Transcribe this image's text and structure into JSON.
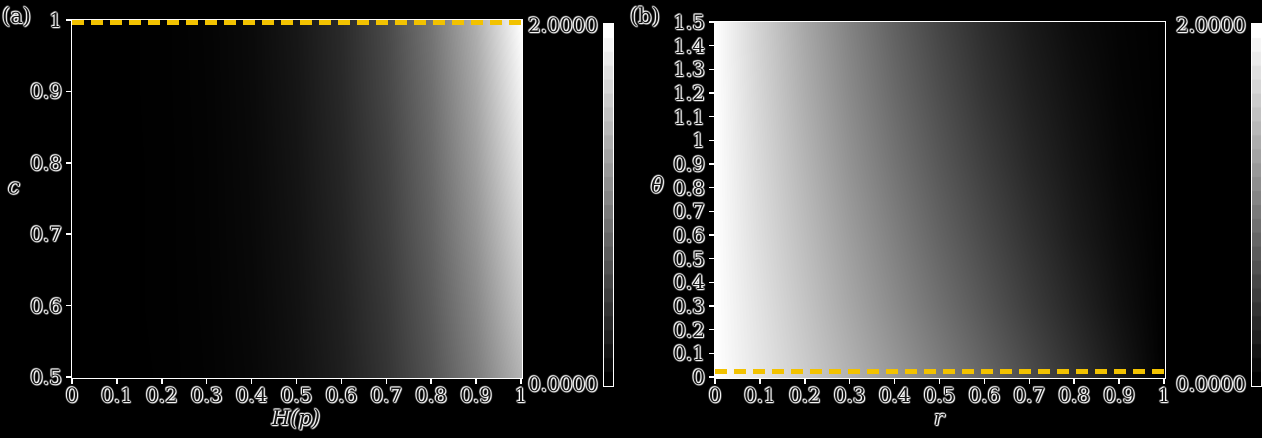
{
  "figure": {
    "background": "#000000",
    "text_color": "#161616",
    "halo_color": "#ffffff",
    "axis_color": "#ffffff",
    "dash_color": "#f2c200"
  },
  "panel_a": {
    "tag": "(a)",
    "xlabel": "H(p)",
    "ylabel": "c",
    "x_tick_labels": [
      "0",
      "0.1",
      "0.2",
      "0.3",
      "0.4",
      "0.5",
      "0.6",
      "0.7",
      "0.8",
      "0.9",
      "1"
    ],
    "y_tick_labels": [
      "1",
      "0.9",
      "0.8",
      "0.7",
      "0.6",
      "0.5"
    ],
    "colorbar": {
      "max_label": "2.0000",
      "min_label": "0.0000"
    },
    "dashed_line": "horizontal dashed line at c = 1 (top edge)"
  },
  "panel_b": {
    "tag": "(b)",
    "xlabel": "r",
    "ylabel": "θ",
    "x_tick_labels": [
      "0",
      "0.1",
      "0.2",
      "0.3",
      "0.4",
      "0.5",
      "0.6",
      "0.7",
      "0.8",
      "0.9",
      "1"
    ],
    "y_tick_labels": [
      "1.5",
      "1.4",
      "1.3",
      "1.2",
      "1.1",
      "1",
      "0.9",
      "0.8",
      "0.7",
      "0.6",
      "0.5",
      "0.4",
      "0.3",
      "0.2",
      "0.1",
      "0"
    ],
    "colorbar": {
      "max_label": "2.0000",
      "min_label": "0.0000"
    },
    "dashed_line": "horizontal dashed line at θ = 0 (bottom edge)"
  },
  "chart_data": [
    {
      "type": "heatmap",
      "panel": "a",
      "xlabel": "H(p)",
      "ylabel": "c",
      "x": [
        0,
        0.1,
        0.2,
        0.3,
        0.4,
        0.5,
        0.6,
        0.7,
        0.8,
        0.9,
        1
      ],
      "y": [
        1.0,
        0.9,
        0.8,
        0.7,
        0.6,
        0.5
      ],
      "xlim": [
        0,
        1
      ],
      "ylim": [
        0.5,
        1
      ],
      "zlim": [
        0,
        2
      ],
      "colormap": "grayscale (0 = black, 2 = white)",
      "colorbar_ticks": [
        "2.0000",
        "0.0000"
      ],
      "annotation": "yellow dashed line at c = 1",
      "values": [
        [
          0,
          0.001,
          0.007,
          0.03,
          0.08,
          0.18,
          0.33,
          0.57,
          0.92,
          1.38,
          2.0
        ],
        [
          0,
          0.001,
          0.007,
          0.028,
          0.077,
          0.17,
          0.32,
          0.55,
          0.87,
          1.31,
          1.9
        ],
        [
          0,
          0.001,
          0.006,
          0.026,
          0.072,
          0.16,
          0.3,
          0.51,
          0.82,
          1.24,
          1.79
        ],
        [
          0,
          0.001,
          0.006,
          0.025,
          0.068,
          0.15,
          0.28,
          0.48,
          0.77,
          1.16,
          1.67
        ],
        [
          0,
          0.001,
          0.006,
          0.023,
          0.063,
          0.14,
          0.26,
          0.44,
          0.71,
          1.07,
          1.55
        ],
        [
          0,
          0.0,
          0.005,
          0.021,
          0.057,
          0.13,
          0.24,
          0.41,
          0.65,
          0.98,
          1.41
        ]
      ]
    },
    {
      "type": "heatmap",
      "panel": "b",
      "xlabel": "r",
      "ylabel": "θ",
      "x": [
        0,
        0.1,
        0.2,
        0.3,
        0.4,
        0.5,
        0.6,
        0.7,
        0.8,
        0.9,
        1
      ],
      "y": [
        1.5,
        1.2,
        0.9,
        0.6,
        0.3,
        0.0
      ],
      "xlim": [
        0,
        1
      ],
      "ylim": [
        0,
        1.5
      ],
      "zlim": [
        0,
        2
      ],
      "colormap": "grayscale (0 = black, 2 = white)",
      "colorbar_ticks": [
        "2.0000",
        "0.0000"
      ],
      "annotation": "yellow dashed line at θ = 0",
      "values": [
        [
          2,
          1.64,
          1.31,
          1.02,
          0.76,
          0.54,
          0.35,
          0.2,
          0.09,
          0.03,
          0
        ],
        [
          2,
          1.67,
          1.36,
          1.08,
          0.83,
          0.61,
          0.41,
          0.25,
          0.13,
          0.04,
          0
        ],
        [
          2,
          1.7,
          1.42,
          1.15,
          0.91,
          0.69,
          0.49,
          0.31,
          0.17,
          0.06,
          0
        ],
        [
          2,
          1.73,
          1.48,
          1.23,
          1.0,
          0.78,
          0.58,
          0.39,
          0.22,
          0.09,
          0
        ],
        [
          2,
          1.77,
          1.54,
          1.31,
          1.09,
          0.88,
          0.68,
          0.48,
          0.3,
          0.13,
          0
        ],
        [
          2,
          1.8,
          1.6,
          1.4,
          1.2,
          1.0,
          0.8,
          0.6,
          0.4,
          0.2,
          0
        ]
      ]
    }
  ]
}
